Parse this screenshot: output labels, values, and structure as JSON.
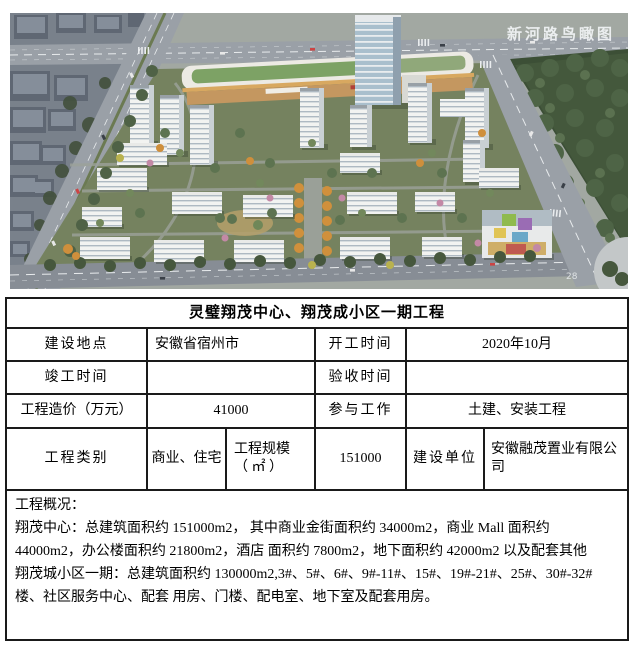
{
  "photo": {
    "caption": "新河路鸟瞰图",
    "road_marker": "28"
  },
  "table": {
    "title": "灵璧翔茂中心、翔茂成小区一期工程",
    "row1": {
      "l1": "建设地点",
      "v1": "安徽省宿州市",
      "l2": "开工时间",
      "v2": "2020年10月"
    },
    "row2": {
      "l1": "竣工时间",
      "v1": "",
      "l2": "验收时间",
      "v2": ""
    },
    "row3": {
      "l1": "工程造价（万元）",
      "v1": "41000",
      "l2": "参与工作",
      "v2": "土建、安装工程"
    },
    "row4": {
      "l1": "工程类别",
      "v1": "商业、住宅",
      "l2a": "工程规模",
      "l2b": "（ ㎡ ）",
      "v2": "151000",
      "l3": "建设单位",
      "v3": "安徽融茂置业有限公司"
    },
    "overview": {
      "heading": "工程概况：",
      "line1": "翔茂中心：总建筑面积约 151000m2， 其中商业金街面积约 34000m2，商业 Mall 面积约",
      "line2": "44000m2，办公楼面积约 21800m2，酒店 面积约 7800m2，地下面积约 42000m2 以及配套其他",
      "line3": "翔茂城小区一期：总建筑面积约 130000m2,3#、5#、6#、9#-11#、15#、19#-21#、25#、30#-32#",
      "line4": "楼、社区服务中心、配套 用房、门楼、配电室、地下室及配套用房。"
    }
  },
  "colors": {
    "table_border": "#1a1a1a",
    "caption_text": "#f2f4f6"
  }
}
